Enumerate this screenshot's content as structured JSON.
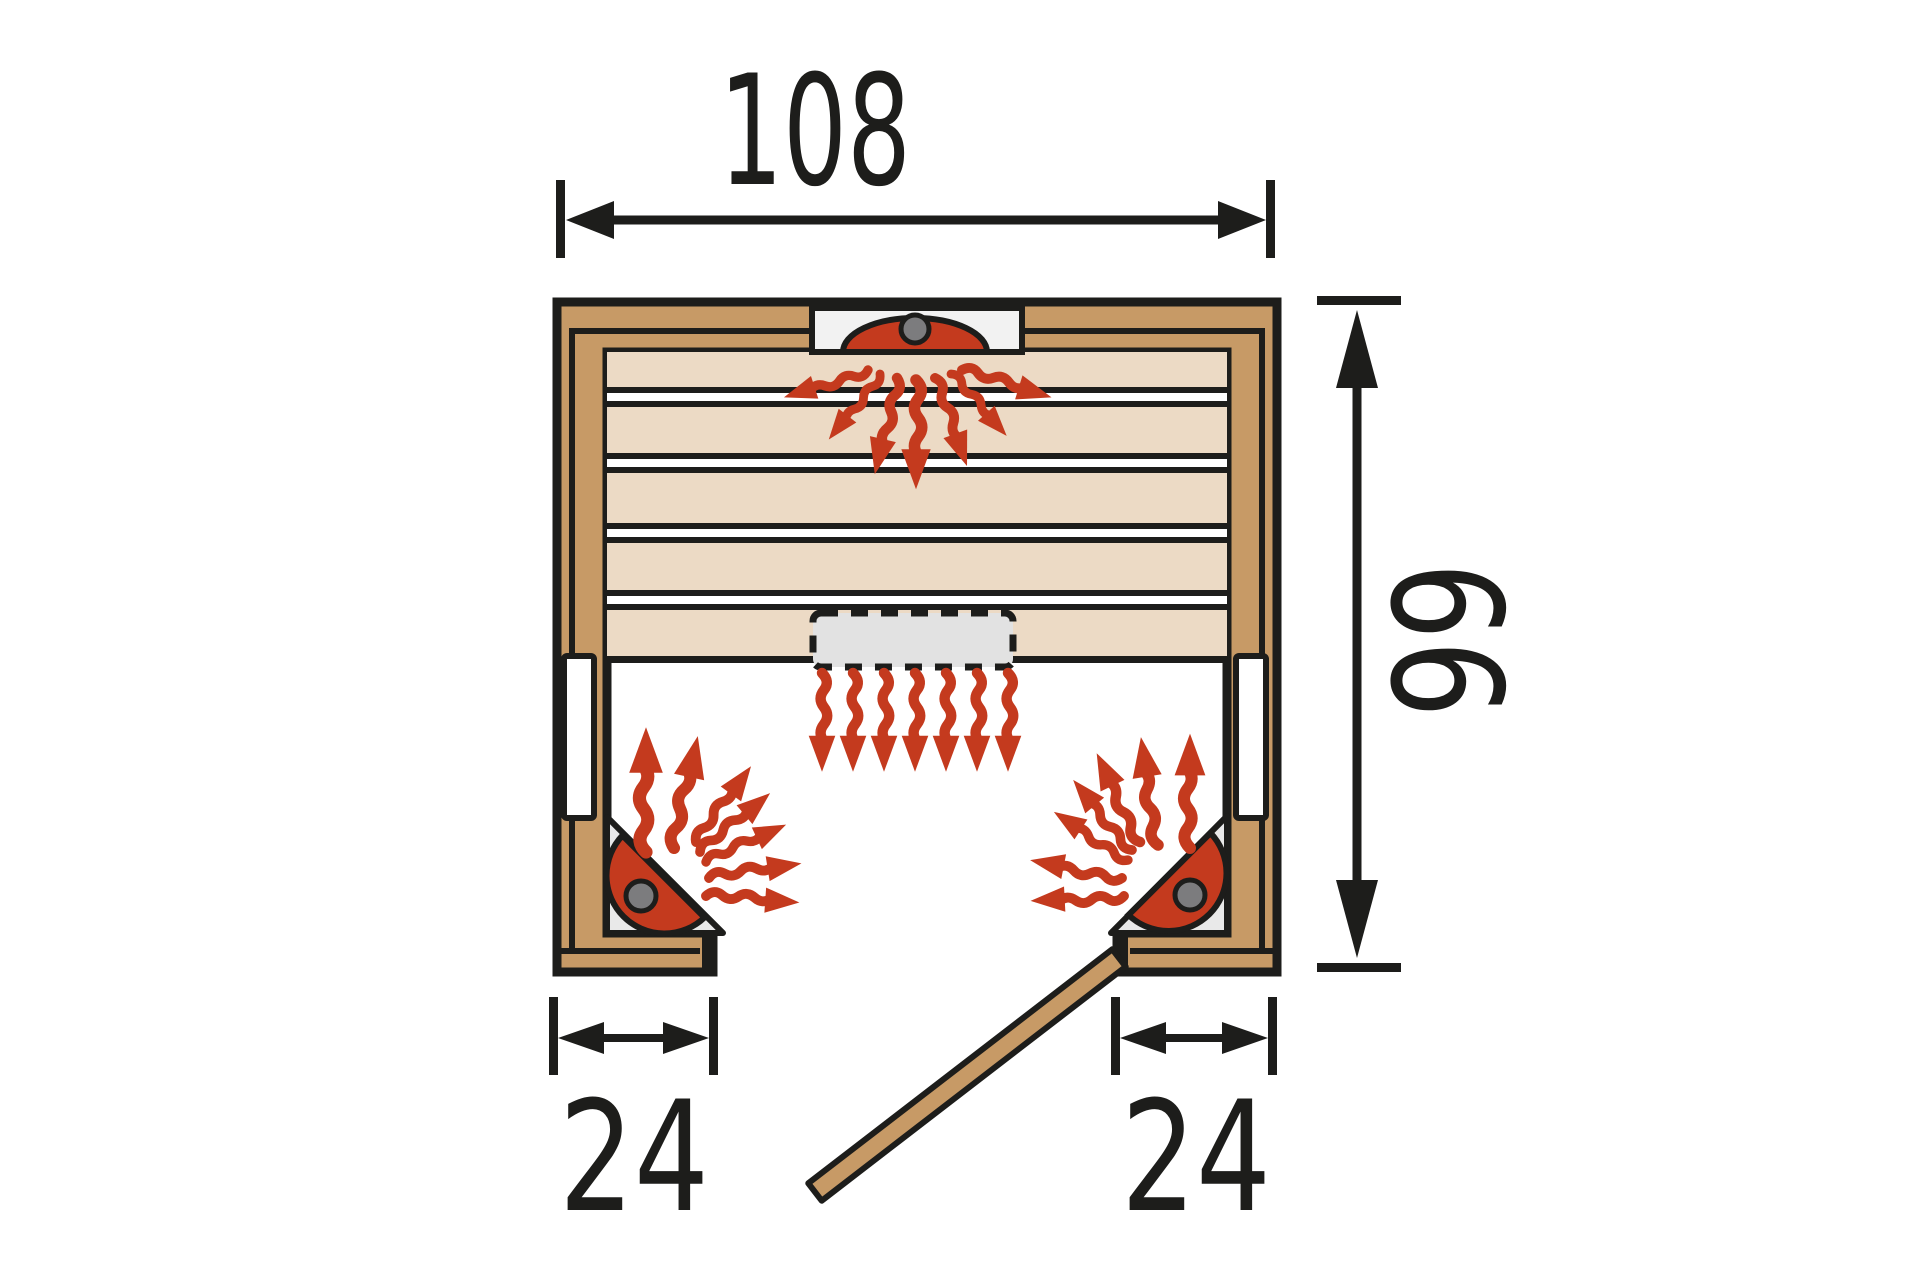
{
  "diagram": {
    "kind": "sauna-floor-plan",
    "dimensions": {
      "width": {
        "value": "108"
      },
      "depth": {
        "value": "99"
      },
      "front_left": {
        "value": "24"
      },
      "front_right": {
        "value": "24"
      }
    },
    "colors": {
      "line": "#1D1D1B",
      "wood": "#C79A66",
      "bench": "#ECDAC5",
      "heat_red": "#C43A1E",
      "knob_gray": "#7C7C7E",
      "panel_gray": "#E9E9E9",
      "heater_gray": "#E2E2E2",
      "glass_white": "#FFFFFF"
    },
    "icons": {
      "top_heater": "infrared-heater-icon",
      "corner_heater_left": "infrared-heater-icon",
      "corner_heater_right": "infrared-heater-icon",
      "under_bench_heater": "hidden-heater-dashed-icon",
      "heat_arrows": "wavy-heat-arrow-icon",
      "door": "open-door-panel-icon"
    }
  }
}
